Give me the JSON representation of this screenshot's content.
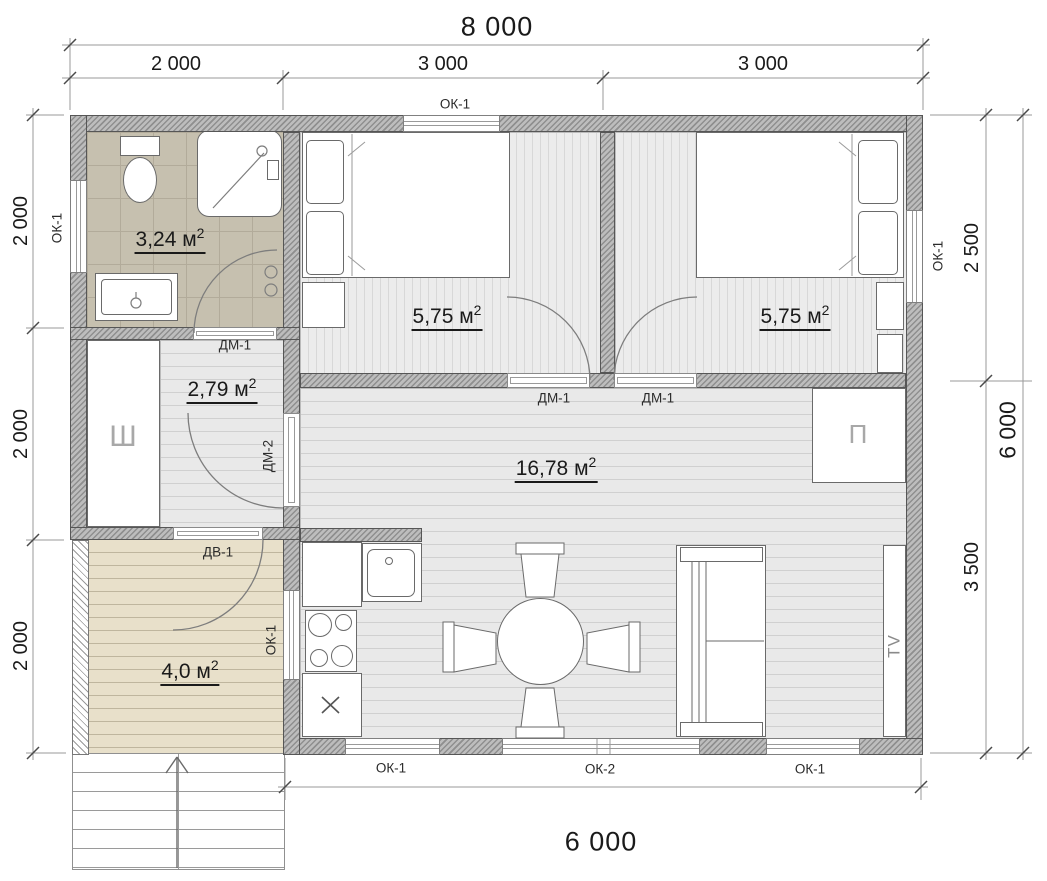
{
  "title": "House floor plan 8000 x 6000",
  "palette": {
    "wall_light": "#bdbdbd",
    "wall_dark": "#8f8f8f",
    "outline": "#565656",
    "floor_bg": "#e9e9e9",
    "floor_line": "#d0d0d0",
    "bed_bg": "#ececec",
    "bed_line": "#d8d8d8",
    "tile_bg": "#c6c0af",
    "tile_line": "#b2ab9a",
    "porch_bg": "#e8e0ca",
    "porch_line": "#bfb69e",
    "dim_line": "#9a9a9a",
    "tick": "#4a4a4a",
    "text": "#1a1a1a"
  },
  "dims": {
    "top_total": "8 000",
    "top_segments": [
      "2 000",
      "3 000",
      "3 000"
    ],
    "left_segments": [
      "2 000",
      "2 000",
      "2 000"
    ],
    "right_segments": [
      "2 500",
      "3 500"
    ],
    "right_total": "6 000",
    "bottom_total": "6 000"
  },
  "rooms": {
    "bathroom": {
      "area": "3,24 м",
      "sup": "2"
    },
    "hallway": {
      "area": "2,79 м",
      "sup": "2"
    },
    "bedroom1": {
      "area": "5,75 м",
      "sup": "2"
    },
    "bedroom2": {
      "area": "5,75 м",
      "sup": "2"
    },
    "living": {
      "area": "16,78 м",
      "sup": "2"
    },
    "porch": {
      "area": "4,0 м",
      "sup": "2"
    }
  },
  "windows": {
    "top": "ОК-1",
    "left": "ОК-1",
    "right": "ОК-1",
    "porch": "ОК-1",
    "bottom_left": "ОК-1",
    "bottom_center": "ОК-2",
    "bottom_right": "ОК-1"
  },
  "doors": {
    "bathroom": "ДМ-1",
    "bedroom1": "ДМ-1",
    "bedroom2": "ДМ-1",
    "hallway": "ДМ-2",
    "entrance": "ДВ-1"
  },
  "furniture": {
    "wardrobe_letter": "Ш",
    "closet_letter": "П",
    "tv_label": "TV"
  }
}
